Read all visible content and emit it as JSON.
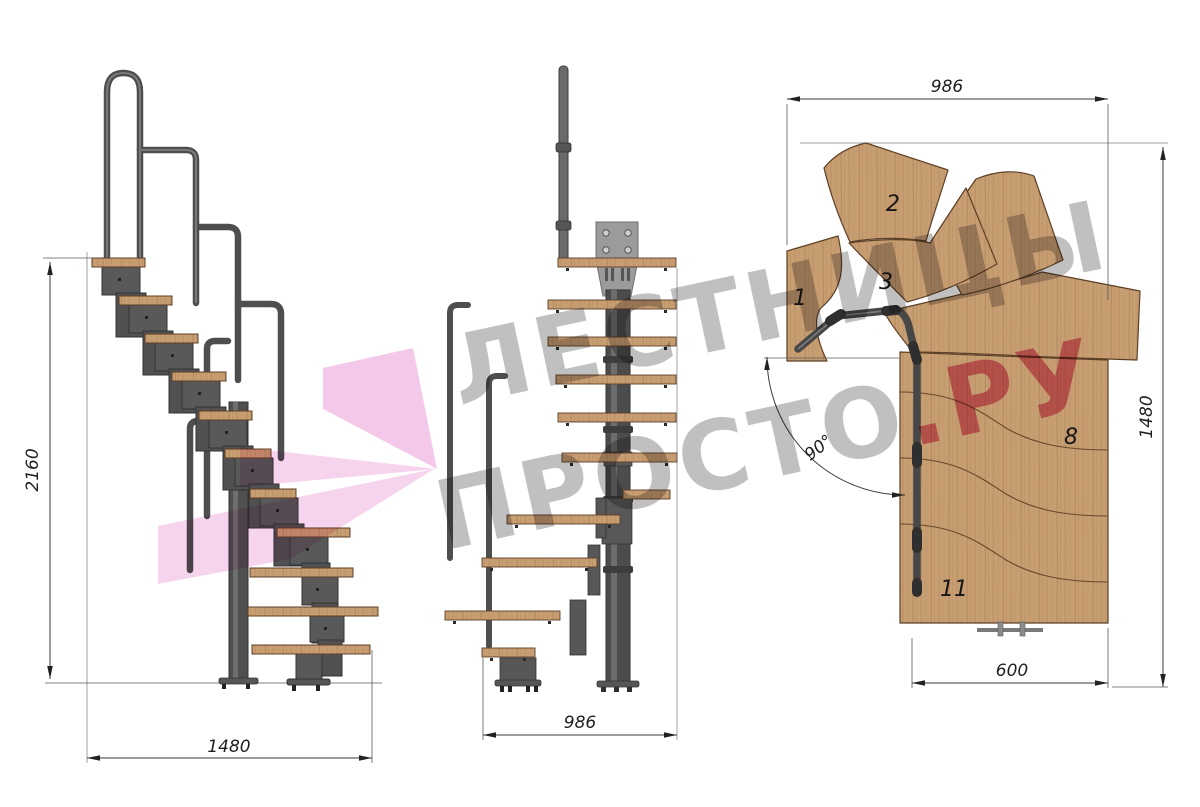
{
  "watermark": {
    "line1": "ЛЕСТНИЦЫ",
    "line2_grey": "ПРОСТО",
    "line2_pink": ".РУ"
  },
  "dimensions": {
    "side_height": "2160",
    "side_width": "1480",
    "front_width": "986",
    "plan_width_top": "986",
    "plan_height_right": "1480",
    "plan_width_bottom": "600",
    "plan_angle": "90°"
  },
  "plan_tread_labels": [
    "1",
    "2",
    "3",
    "8",
    "11"
  ],
  "colors": {
    "wood": "#c79d72",
    "wood_grain": "#a87c50",
    "metal": "#555555",
    "metal_dark": "#3c3c3c",
    "plate_grey": "#9b9b9b",
    "dimension_line": "#3a3a3a",
    "watermark_grey": "#7c7c7c",
    "watermark_pink": "#d22d64",
    "logo_pink": "#f0b6e0"
  }
}
